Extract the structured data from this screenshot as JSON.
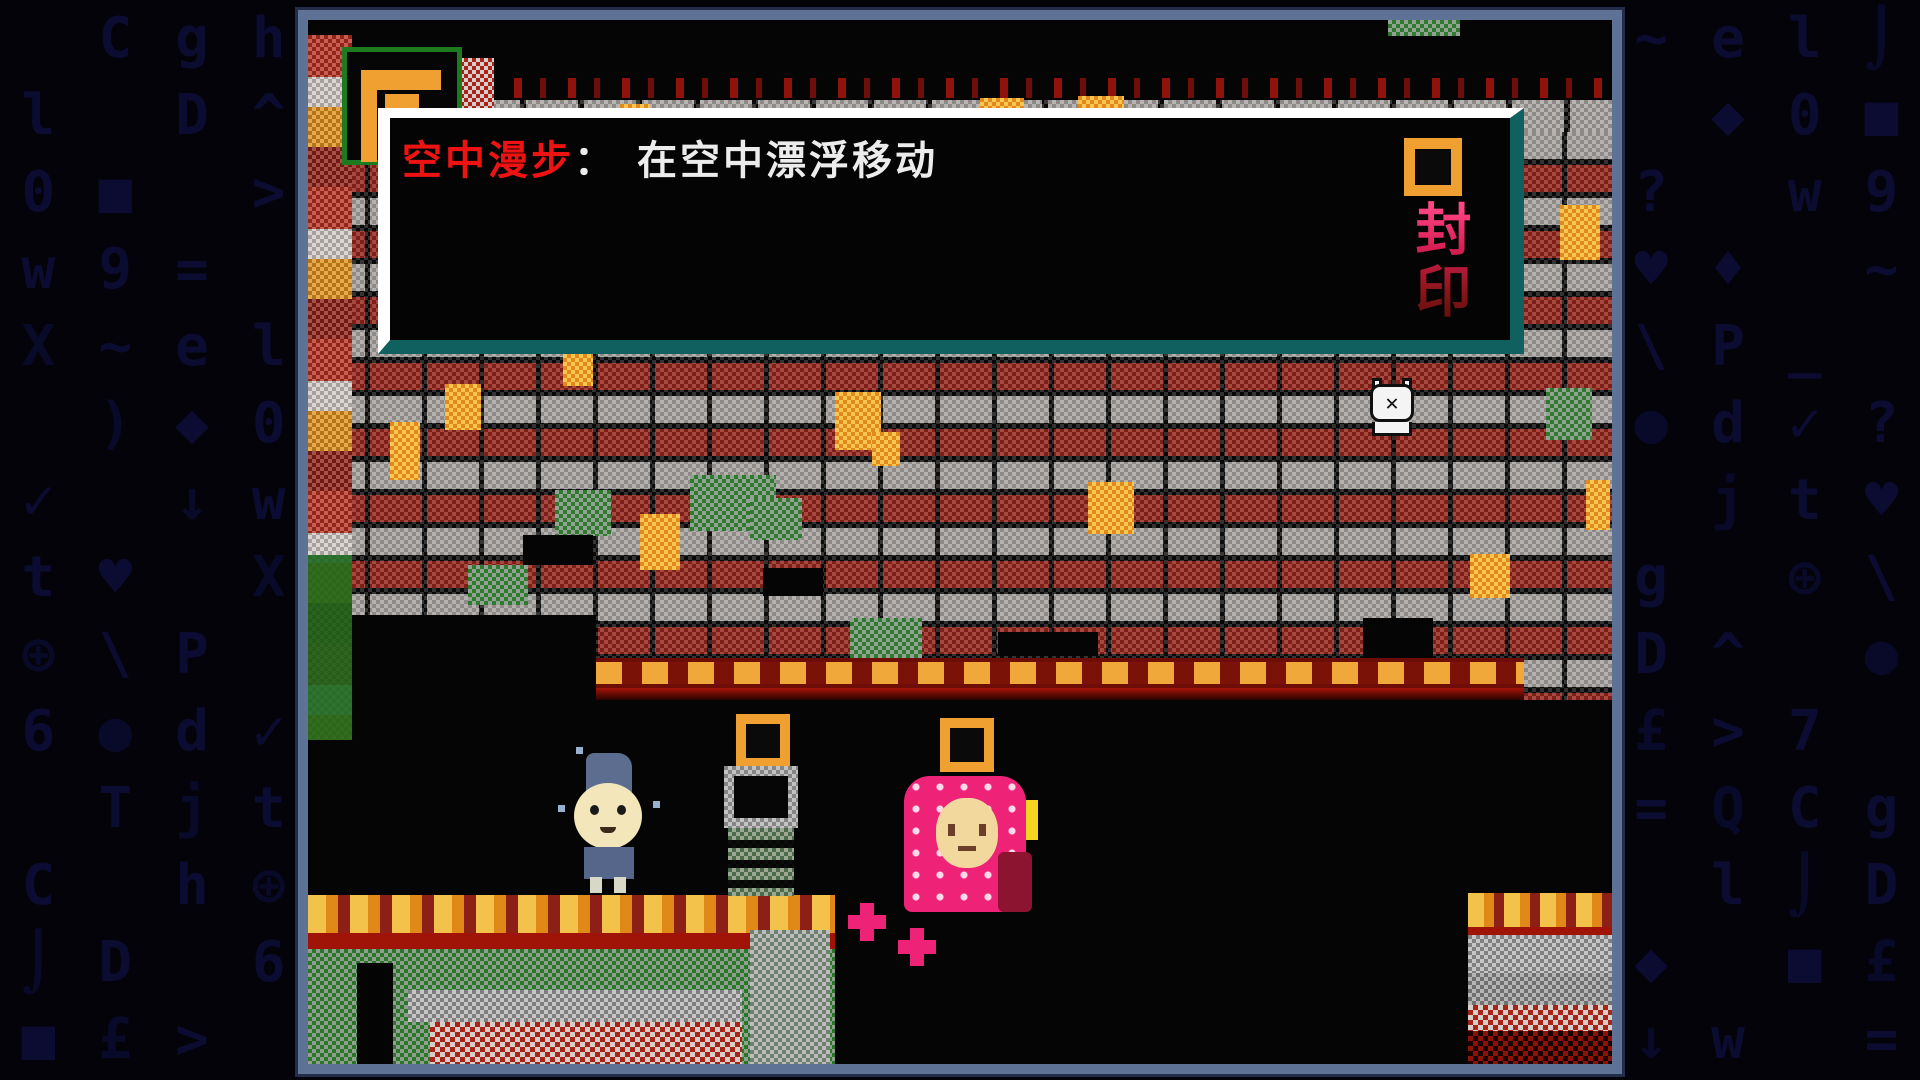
{
  "dialog": {
    "term": "空中漫步",
    "separator": "：",
    "description": "在空中漂浮移动"
  },
  "sign": {
    "text": "封印"
  },
  "background": {
    "glyphs": [
      "Q",
      "t",
      "9",
      "T",
      "↓",
      ">",
      "✓",
      "■",
      "●",
      "◆",
      "^",
      "_",
      "⌡",
      "\\",
      "e",
      "h",
      "X",
      "C",
      "♥",
      "=",
      "j",
      "w",
      "7",
      "?",
      "£",
      "d",
      "0",
      "6",
      ")",
      "D",
      "P",
      "l",
      "⊕",
      "~",
      "g",
      "♦"
    ]
  },
  "colors": {
    "frame": "#5d7294",
    "dialog_border_light": "#ffffff",
    "dialog_border_teal": "#10605f",
    "term_red": "#ee1313",
    "text_white": "#ececec",
    "accent_orange": "#f0a030",
    "npc_pink": "#ee2277",
    "box_green": "#1e7a1e",
    "glyph_navy": "#0c0c33"
  }
}
